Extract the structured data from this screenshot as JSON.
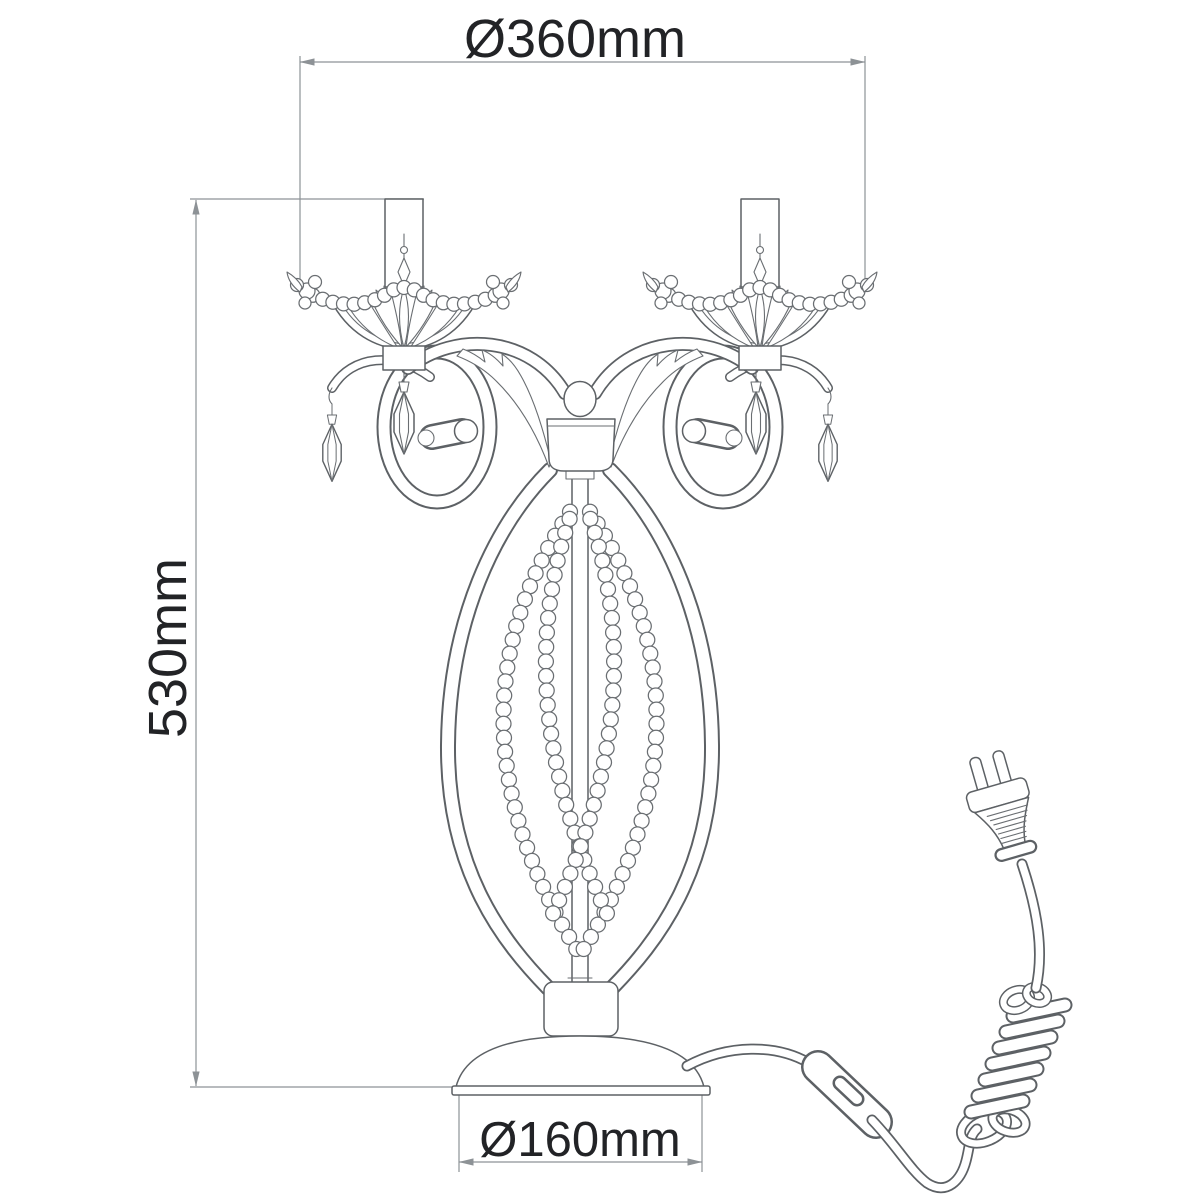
{
  "diagram": {
    "type": "technical-dimension-drawing",
    "subject": "two-arm crystal candelabra table lamp with power cord, inline switch and Euro plug",
    "dimensions": {
      "top_width_label": "Ø360mm",
      "height_label": "530mm",
      "base_diameter_label": "Ø160mm"
    },
    "colors": {
      "background": "#ffffff",
      "drawing_line": "#5d6165",
      "dimension_line": "#8d9296",
      "label_text": "#222326"
    }
  }
}
